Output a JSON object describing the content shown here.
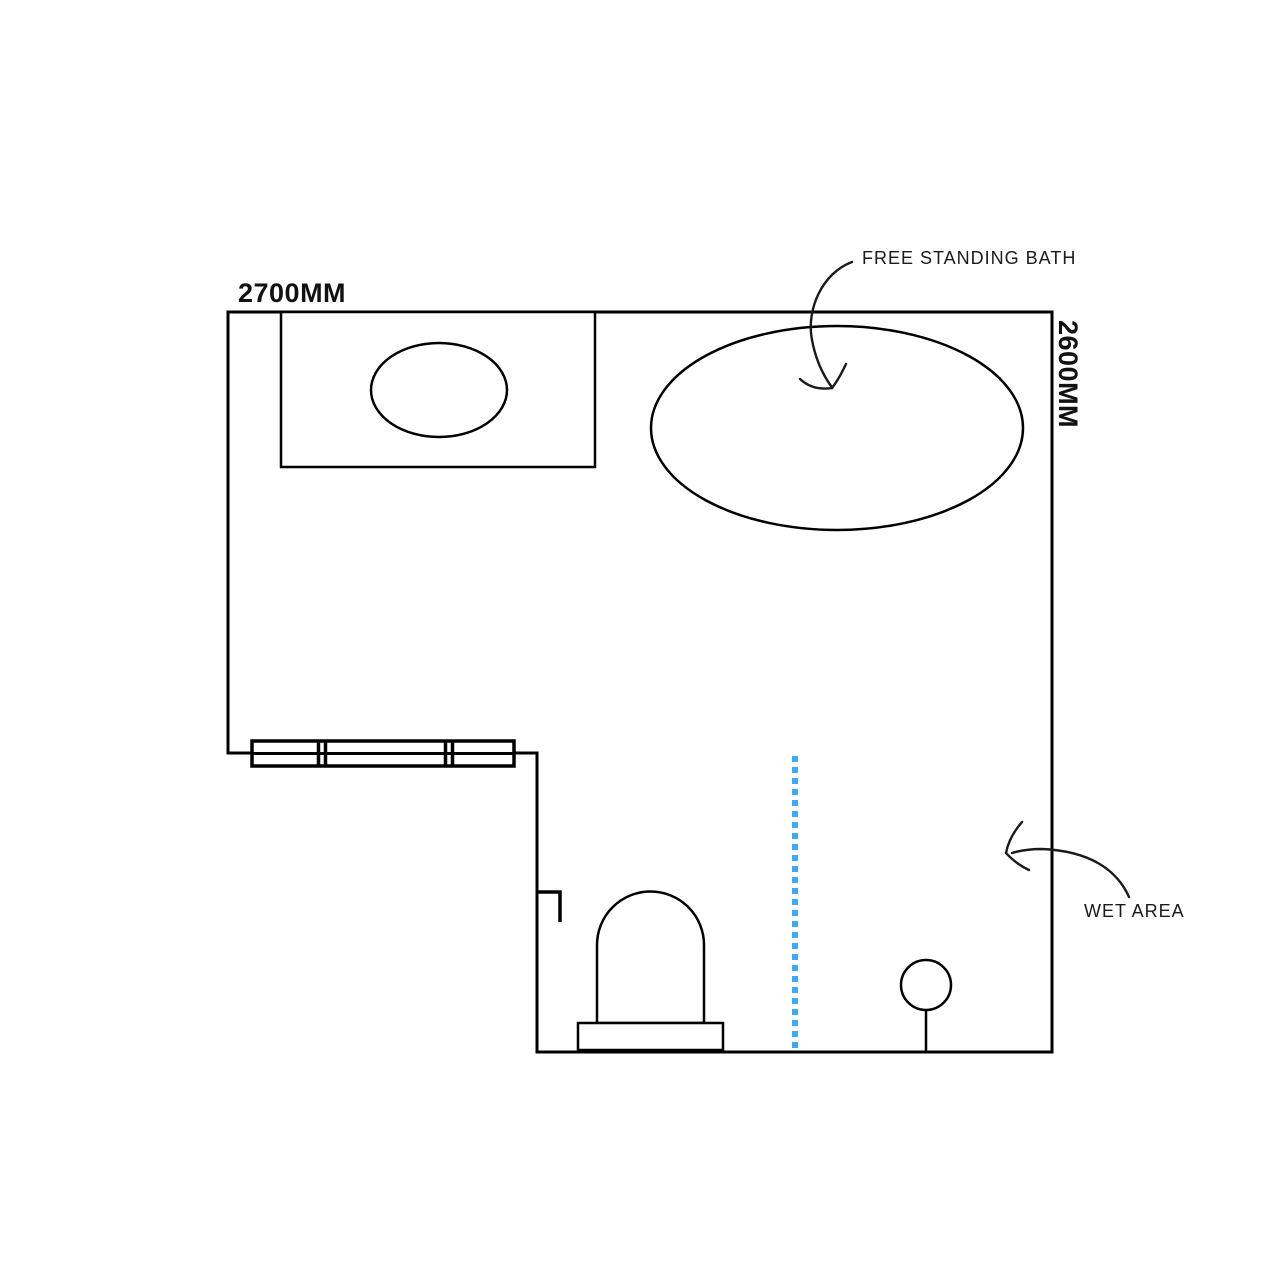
{
  "canvas": {
    "width": 1280,
    "height": 1280,
    "background": "#ffffff"
  },
  "colors": {
    "line": "#000000",
    "wet_divider_blue": "#3FA9F5"
  },
  "labels": {
    "width_dimension": "2700MM",
    "height_dimension": "2600MM",
    "bath_annotation": "FREE STANDING BATH",
    "wet_area_annotation": "WET AREA"
  },
  "fixtures": {
    "room": "l-shaped-bathroom-outline",
    "vanity": "vanity-counter-with-basin",
    "bath": "free-standing-oval-bath",
    "door": "sliding-door-window-symbol",
    "toilet": "toilet-with-cistern",
    "shower": "shower-point",
    "divider": "wet-area-dotted-divider",
    "bracket": "wall-return-detail"
  }
}
